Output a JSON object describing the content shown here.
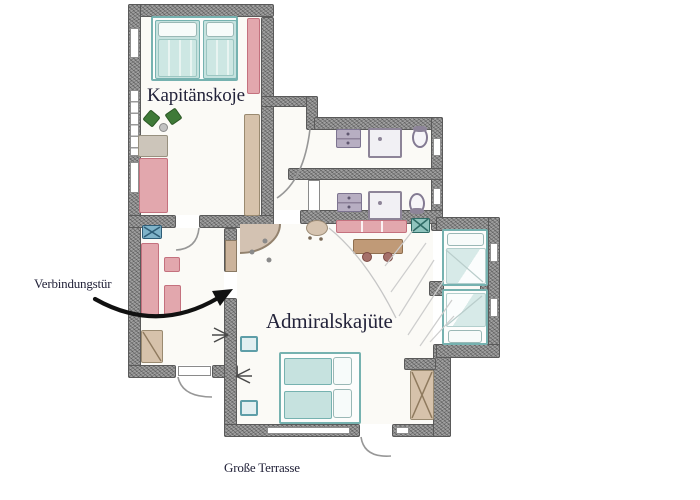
{
  "labels": {
    "kapitaenskoje": "Kapitänskoje",
    "admiralskajuete": "Admiralskajüte",
    "verbindungstuer": "Verbindungstür",
    "grosse_terrasse": "Große Terrasse"
  },
  "colors": {
    "wall_gray": "#8e8e8e",
    "wall_outline": "#5a5a5a",
    "bed_teal": "#76b2b0",
    "bed_teal_fill": "#cde7e3",
    "furniture_pink": "#e2a7ad",
    "furniture_pink_outline": "#c4717e",
    "furniture_tan": "#d6c2ab",
    "bath_fixture_purple": "#b7aec2",
    "bath_fixture_outline": "#7d7490",
    "chair_green": "#3f7a38",
    "sink_blue": "#7fb3c9",
    "table_brown": "#c09a77",
    "label_ink": "#23233a",
    "arrow_black": "#111111"
  }
}
